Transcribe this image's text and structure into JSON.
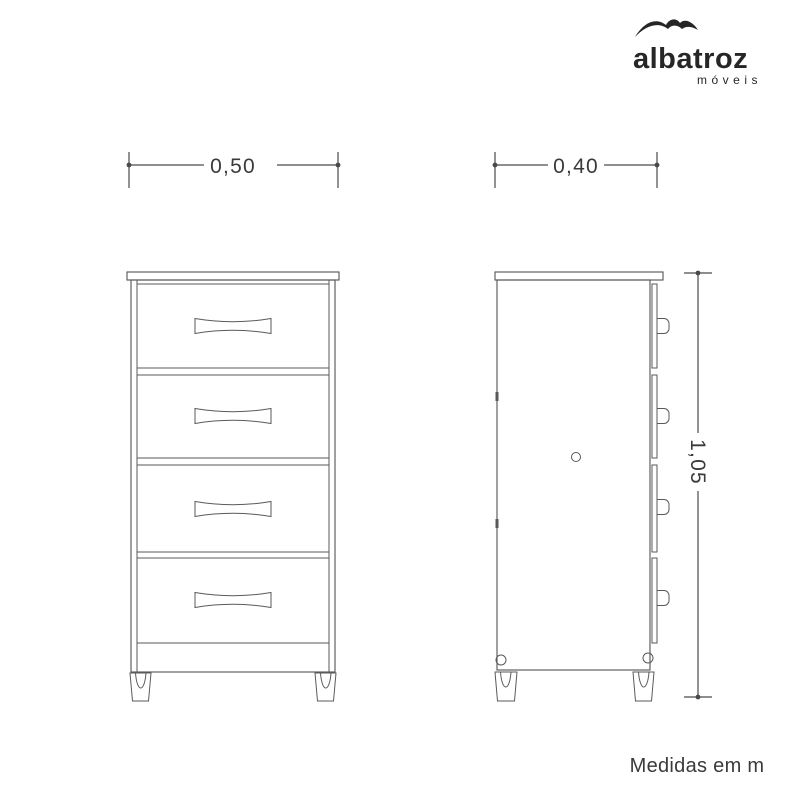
{
  "colors": {
    "background": "#ffffff",
    "line": "#5a5a5a",
    "dim": "#4a4a4a",
    "text": "#3a3a3a",
    "logo": "#262626"
  },
  "logo": {
    "brand": "albatroz",
    "subtitle": "móveis",
    "icon": "albatross-bird-icon"
  },
  "views": {
    "front": {
      "title": "front view",
      "width_label": "0,50",
      "width_m": 0.5,
      "drawer_count": 4
    },
    "side": {
      "title": "side view",
      "depth_label": "0,40",
      "depth_m": 0.4,
      "height_label": "1,05",
      "height_m": 1.05
    }
  },
  "footer": {
    "note": "Medidas em m"
  }
}
